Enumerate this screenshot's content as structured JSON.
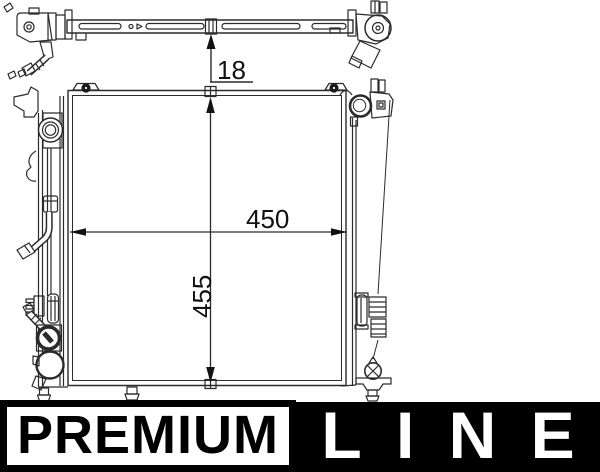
{
  "drawing": {
    "stroke_color": "#2b2b2b",
    "dimensions": {
      "bar_height": "18",
      "core_width": "450",
      "core_height": "455"
    }
  },
  "branding": {
    "premium_label": "PREMIUM",
    "line_label": "LINE",
    "colors": {
      "premium_bg": "#ffffff",
      "premium_border": "#000000",
      "premium_text": "#000000",
      "line_bg": "#000000",
      "line_text": "#ffffff"
    }
  }
}
